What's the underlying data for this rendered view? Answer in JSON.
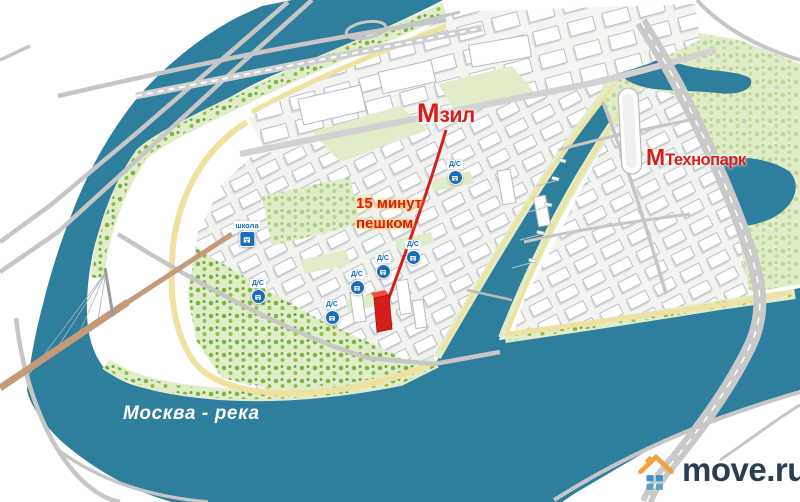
{
  "map": {
    "labels": {
      "metro_zil": {
        "m": "М",
        "name": "зил"
      },
      "metro_tehnopark": {
        "m": "М",
        "name": "Технопарк"
      },
      "walk_line1": "15 минут",
      "walk_line2": "пешком",
      "river": "Москва - река",
      "school": "школа",
      "kindergarten": "Д/С"
    },
    "icons": {
      "metro": "metro-m-icon",
      "kindergarten": "kindergarten-circle-icon",
      "school": "school-square-icon",
      "logo": "house-icon"
    },
    "colors": {
      "water": "#2e7e9d",
      "park-light": "#e0edc8",
      "tree-green": "#7db544",
      "embankment": "#efe2a0",
      "road-gray": "#c6c6c6",
      "building-fill": "#ffffff",
      "building-stroke": "#b5bac1",
      "accent-red": "#d51f1a",
      "icon-blue": "#1b6dbc",
      "logo-navy": "#2b3e50",
      "logo-orange": "#f2a13e",
      "logo-blue": "#3d8fc4"
    }
  },
  "brand": {
    "name": "move.ru"
  }
}
